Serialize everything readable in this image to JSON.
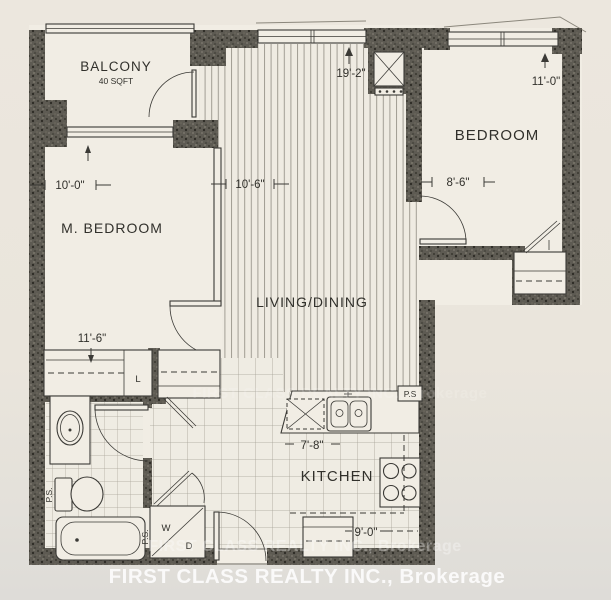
{
  "page": {
    "background": "#eae5dc",
    "paper_light": "#f1ede4",
    "wall_color": "#5e5b53",
    "ink": "#3b3a36"
  },
  "rooms": {
    "balcony": {
      "label": "BALCONY",
      "area": "40 SQFT"
    },
    "master_bedroom": {
      "label": "M. BEDROOM",
      "dim_top": "10'-0\"",
      "dim_bottom": "11'-6\""
    },
    "living_dining": {
      "label": "LIVING/DINING",
      "dim_top": "19'-2\"",
      "dim_upper_left": "10'-6\""
    },
    "bedroom": {
      "label": "BEDROOM",
      "dim_top_right": "11'-0\"",
      "dim_left": "8'-6\""
    },
    "kitchen": {
      "label": "KITCHEN",
      "dim_counter": "7'-8\"",
      "dim_bottom": "9'-0\""
    }
  },
  "fixtures": {
    "washer": "W",
    "dryer": "D",
    "linen_closet": "L",
    "pipe_shaft_kitchen": "P.S",
    "pipe_shaft_bath": "P.S.",
    "pipe_shaft_laundry": "P.S."
  },
  "watermarks": {
    "row_top": "FIRST CLASS REALTY INC., Brokerage",
    "row_mid": "FIRST CLASS REALTY INC., Brokerage",
    "row_main": "FIRST CLASS REALTY INC., Brokerage"
  }
}
